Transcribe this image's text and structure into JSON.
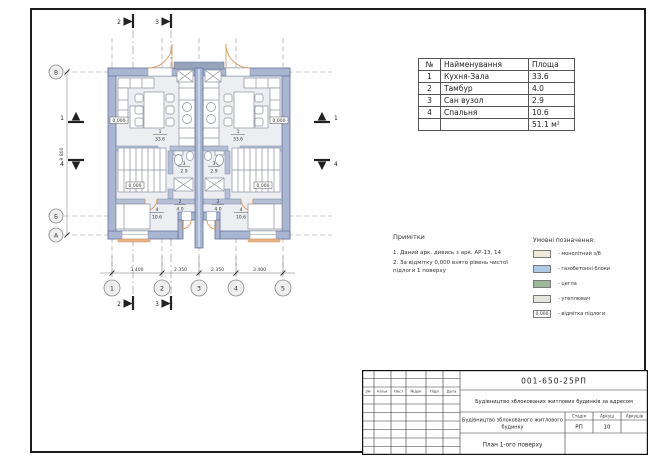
{
  "rooms_table": {
    "headers": {
      "num": "№",
      "name": "Найменування",
      "area": "Площа"
    },
    "rows": [
      {
        "num": "1",
        "name": "Кухня-Зала",
        "area": "33.6"
      },
      {
        "num": "2",
        "name": "Тамбур",
        "area": "4.0"
      },
      {
        "num": "3",
        "name": "Сан вузол",
        "area": "2.9"
      },
      {
        "num": "4",
        "name": "Спальня",
        "area": "10.6"
      }
    ],
    "total_area": "51.1 м²"
  },
  "notes": {
    "title": "Примітки",
    "item1": "1. Даний арк. дивись з арк. АР-13, 14",
    "item2": "2. За відмітку 0,000 взято рівень чистої підлоги 1 поверху"
  },
  "legend": {
    "title": "Умовні позначення:",
    "items": [
      {
        "label": "-  монолітний з/б",
        "color": "#f0e9d7"
      },
      {
        "label": "-  газобетонні блоки",
        "color": "#adc9e5"
      },
      {
        "label": "-  цегла",
        "color": "#9db898"
      },
      {
        "label": "-  утеплювач",
        "color": "#e5e7de"
      },
      {
        "label": "-  відмітка підлоги",
        "mark": "0,000"
      }
    ]
  },
  "plan": {
    "axis_cols": [
      "1",
      "2",
      "3",
      "4",
      "5"
    ],
    "axis_rows": {
      "v": "В",
      "b": "Б",
      "a": "А"
    },
    "dims_bottom": [
      "3 400",
      "2 350",
      "2 350",
      "3 400"
    ],
    "dim_left": "9 800",
    "sections": {
      "s1": "1",
      "s2": "2",
      "s3": "3",
      "s4": "4"
    },
    "elevation": "0,000",
    "room_tags": {
      "kitchen": {
        "num": "1",
        "area": "33.6"
      },
      "tambour": {
        "num": "2",
        "area": "4.0"
      },
      "wc": {
        "num": "3",
        "area": "2.9"
      },
      "bedroom": {
        "num": "4",
        "area": "10.6"
      }
    }
  },
  "title_block": {
    "doc_number": "001-650-25РП",
    "project_name": "Будівництво зблокованих житлових будинків за адресом",
    "object_name_line1": "Будівництво зблокованого житлового",
    "object_name_line2": "будинку",
    "drawing_name": "План 1-ого поверху",
    "columns": [
      "Зм",
      "Кільк",
      "Лист",
      "№док",
      "Підп",
      "Дата"
    ],
    "stage_label": "Стадія",
    "sheet_label": "Аркуш",
    "sheets_label": "Аркушів",
    "stage_value": "РП",
    "sheet_value": "10"
  }
}
